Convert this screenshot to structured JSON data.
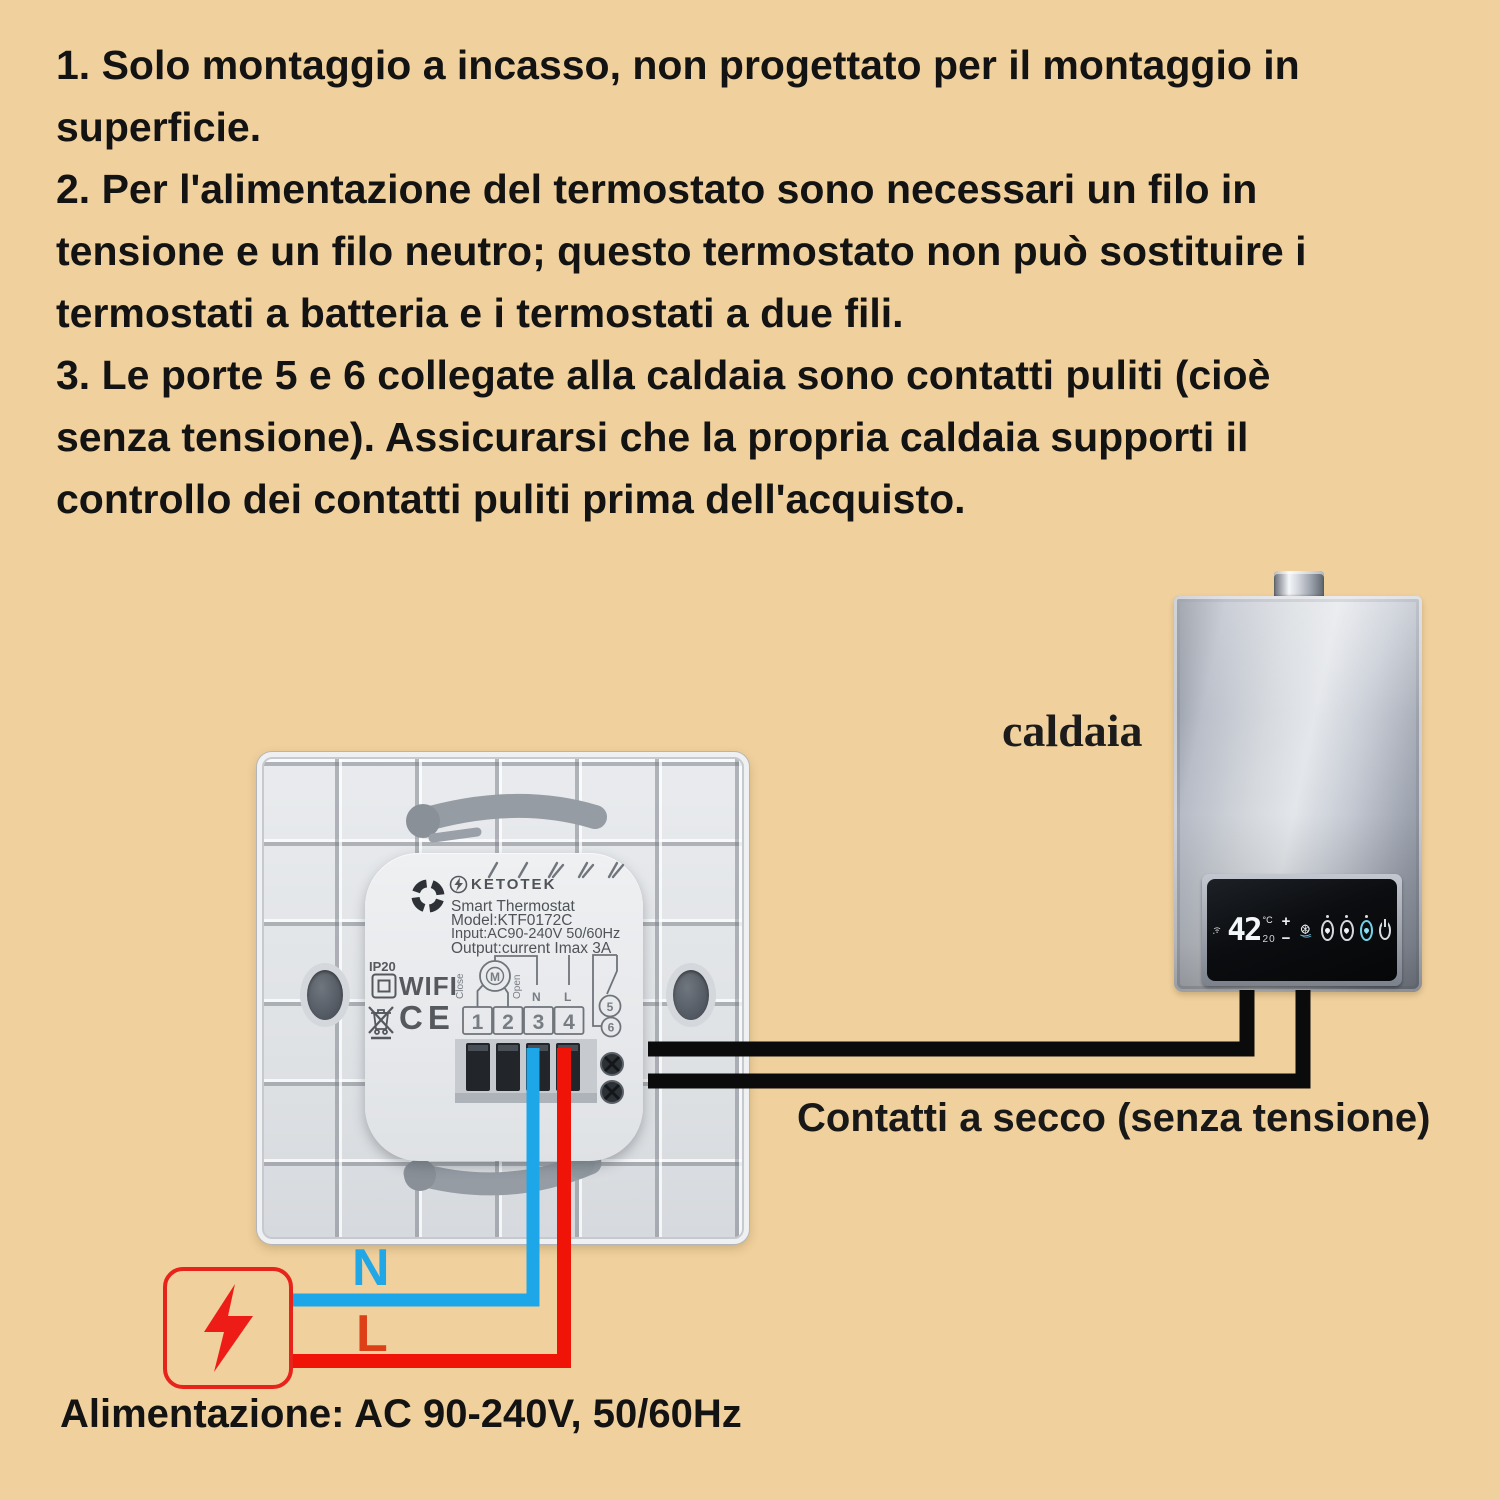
{
  "page": {
    "background": "#f0d09c"
  },
  "instructions": {
    "text": "1. Solo montaggio a incasso, non progettato per il montaggio in\nsuperficie.\n2. Per l'alimentazione del termostato sono necessari un filo in\ntensione e un filo neutro; questo termostato non può sostituire i\ntermostati a batteria e i termostati a due fili.\n3. Le porte 5 e 6 collegate alla caldaia sono contatti puliti (cioè\nsenza tensione). Assicurarsi che la propria caldaia supporti il\ncontrollo dei contatti puliti prima dell'acquisto."
  },
  "boiler": {
    "label": "caldaia",
    "display": {
      "temp": "42",
      "unit": "°C",
      "secondary": "20",
      "plus": "+",
      "minus": "−"
    }
  },
  "thermostat": {
    "brand": "KETOTEK",
    "product": "Smart Thermostat",
    "model": "Model:KTF0172C",
    "input": "Input:AC90-240V 50/60Hz",
    "output": "Output:current Imax 3A",
    "ip_rating": "IP20",
    "wifi": "WIFI",
    "ce_mark": "CE",
    "close_label": "Close",
    "open_label": "Open",
    "motor_label": "M",
    "neutral_label": "N",
    "live_label": "L",
    "terminals": [
      "1",
      "2",
      "3",
      "4"
    ],
    "port5": "5",
    "port6": "6"
  },
  "wiring": {
    "dry_contact_label": "Contatti a secco (senza tensione)",
    "neutral_label": "N",
    "live_label": "L",
    "power_label": "Alimentazione: AC 90-240V, 50/60Hz"
  },
  "colors": {
    "wire_blue": "#1ea7e8",
    "wire_red": "#f01408",
    "wire_black": "#0b0b0b",
    "power_border_red": "#e8231c",
    "live_text_red": "#dd3f16",
    "neutral_text_blue": "#22a7e6"
  }
}
